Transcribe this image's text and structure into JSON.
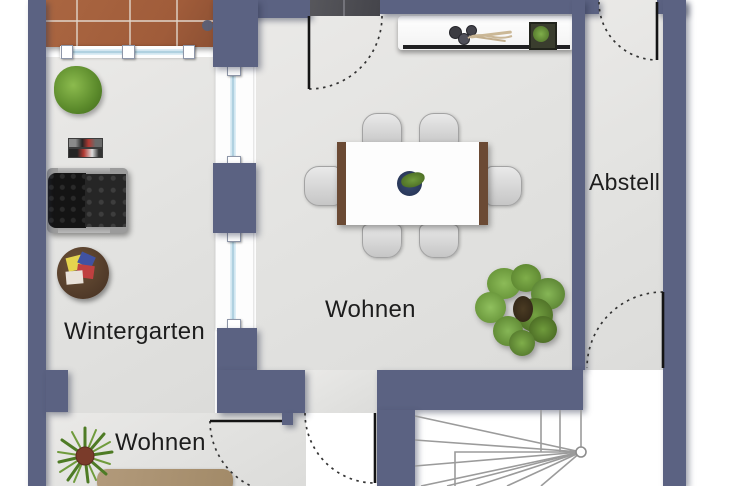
{
  "plan": {
    "type": "floor-plan",
    "rooms": [
      {
        "name": "wintergarten",
        "label": "Wintergarten"
      },
      {
        "name": "wohnen-main",
        "label": "Wohnen"
      },
      {
        "name": "abstell",
        "label": "Abstell"
      },
      {
        "name": "wohnen-lower",
        "label": "Wohnen"
      }
    ],
    "colors": {
      "wall": "#5b6282",
      "floor": "#e3e3e1",
      "terrace_tile": "#a5623e",
      "entry_tile": "#4d4d52",
      "window_glass": "#cfe4ef",
      "rug": "#ab9273",
      "wood": "#6b4a34",
      "plant_green": "#74a242",
      "door_line": "#1c1c1c"
    }
  }
}
